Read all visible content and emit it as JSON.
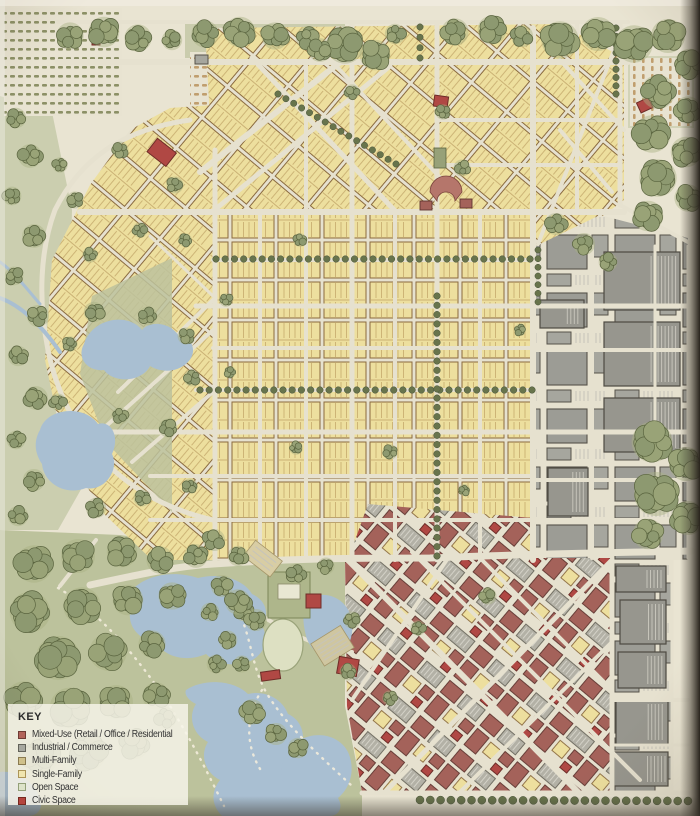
{
  "key": {
    "title": "KEY",
    "items": [
      {
        "id": "mixed-use",
        "label": "Mixed-Use (Retail / Office / Residential",
        "color": "#b2645a",
        "border": "#6e3c34"
      },
      {
        "id": "industrial",
        "label": "Industrial / Commerce",
        "color": "#a7a8a0",
        "border": "#63635a"
      },
      {
        "id": "multi-family",
        "label": "Multi-Family",
        "color": "#cfc08a",
        "border": "#8a7a50"
      },
      {
        "id": "single-family",
        "label": "Single-Family",
        "color": "#f0e5ae",
        "border": "#ac9558"
      },
      {
        "id": "open-space",
        "label": "Open Space",
        "color": "#dde3c9",
        "border": "#93a078"
      },
      {
        "id": "civic-space",
        "label": "Civic Space",
        "color": "#b4453e",
        "border": "#77291f"
      }
    ]
  },
  "palette": {
    "paper": "#e9e4d2",
    "street": "#e6e1cf",
    "single_family": "#eddf9e",
    "single_family_line": "#8a6a3e",
    "multi_family": "#ddbe74",
    "industrial": "#9c9c95",
    "industrial_dark": "#56524a",
    "mixed_use": "#a4625a",
    "mixed_use_dark": "#5f3530",
    "civic": "#b04844",
    "open_space": "#bcc29c",
    "canopy": "#97a178",
    "canopy_dark": "#5a643f",
    "water": "#a9bfd2",
    "orchard_olive": "#7c8153",
    "orchard_tan": "#b9925d",
    "photo_edge": "#2e2820"
  }
}
